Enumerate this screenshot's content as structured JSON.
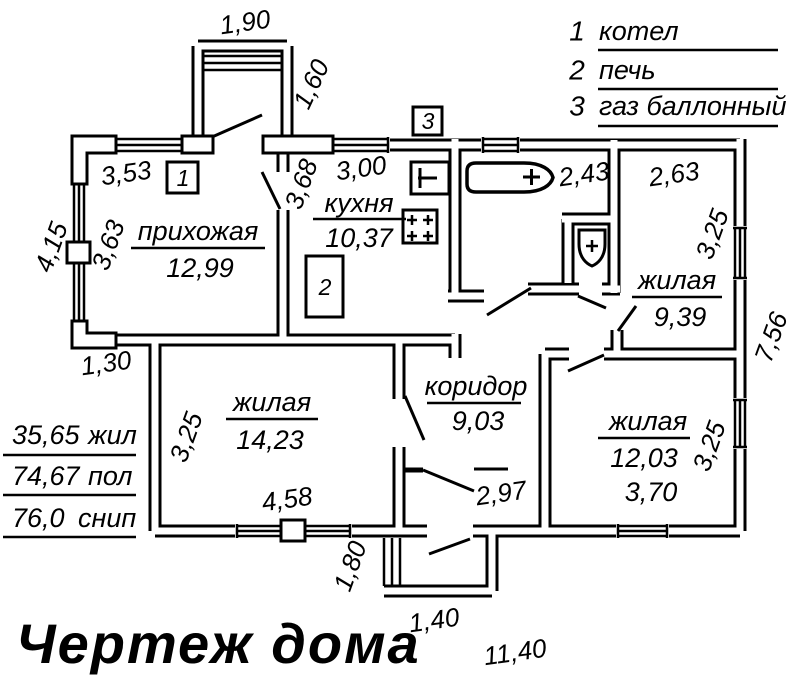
{
  "colors": {
    "ink": "#000000",
    "paper": "#ffffff"
  },
  "title": "Чертеж дома",
  "legend": {
    "items": [
      {
        "num": "1",
        "label": "котел"
      },
      {
        "num": "2",
        "label": "печь"
      },
      {
        "num": "3",
        "label": "газ баллонный"
      }
    ]
  },
  "markers": {
    "boiler": "1",
    "stove": "2",
    "gas": "3"
  },
  "rooms": {
    "hallway": {
      "name": "прихожая",
      "area": "12,99"
    },
    "kitchen": {
      "name": "кухня",
      "area": "10,37"
    },
    "living_ne": {
      "name": "жилая",
      "area": "9,39"
    },
    "living_w": {
      "name": "жилая",
      "area": "14,23"
    },
    "corridor": {
      "name": "коридор",
      "area": "9,03"
    },
    "living_se": {
      "name": "жилая",
      "area": "12,03",
      "width": "3,70"
    }
  },
  "dims": {
    "porch_top_w": "1,90",
    "porch_top_d": "1,60",
    "hall_win": "3,53",
    "left_out": "4,15",
    "left_in": "3,63",
    "kitchen_d": "3,68",
    "kitchen_win": "3,00",
    "bath_w": "2,43",
    "ne_w": "2,63",
    "ne_h": "3,25",
    "right_out": "7,56",
    "step": "1,30",
    "w_h": "3,25",
    "w_win": "4,58",
    "entry": "2,97",
    "se_h": "3,25",
    "porch_bot_d": "1,80",
    "porch_bot_w": "1,40",
    "total_w": "11,40"
  },
  "area_table": {
    "rows": [
      {
        "value": "35,65",
        "label": "жил"
      },
      {
        "value": "74,67",
        "label": "пол"
      },
      {
        "value": "76,0",
        "label": "снип"
      }
    ]
  }
}
